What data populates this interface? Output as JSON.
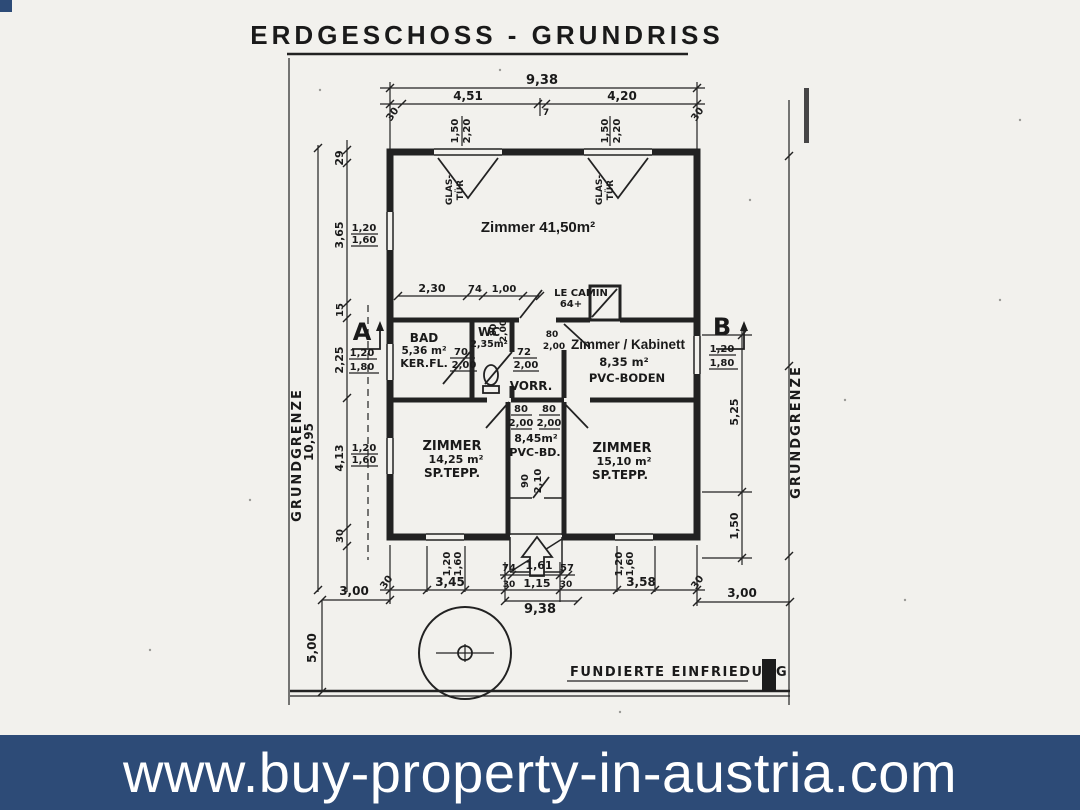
{
  "banner": {
    "text": "www.buy-property-in-austria.com",
    "bg": "#2d4b77",
    "fg": "#ffffff"
  },
  "title": "ERDGESCHOSS - GRUNDRISS",
  "markers": {
    "a": "A",
    "b": "B"
  },
  "site": {
    "boundary_left": "GRUNDGRENZE",
    "boundary_right": "GRUNDGRENZE",
    "fence": "FUNDIERTE EINFRIEDUNG",
    "dim_left_3": "3,00",
    "dim_right_3": "3,00",
    "dim_left_5": "5,00"
  },
  "rooms": {
    "main": "Zimmer 41,50m²",
    "glass_left_1": "GLAS-",
    "glass_left_2": "TÜR",
    "glass_right_1": "GLAS-",
    "glass_right_2": "TÜR",
    "bad_name": "BAD",
    "bad_area": "5,36 m²",
    "bad_floor": "KER.FL.",
    "wc_name": "WC",
    "wc_area": "2,35m²",
    "vorr_name": "VORR.",
    "vorr_area": "8,45m²",
    "vorr_floor": "PVC-BD.",
    "kamin_name": "LE CAMIN",
    "kamin_note": "64+",
    "kab_name": "Zimmer / Kabinett",
    "kab_area": "8,35 m²",
    "kab_floor": "PVC-BODEN",
    "zl_name": "ZIMMER",
    "zl_area": "14,25 m²",
    "zl_floor": "SP.TEPP.",
    "zr_name": "ZIMMER",
    "zr_area": "15,10 m²",
    "zr_floor": "SP.TEPP."
  },
  "dims": {
    "top_total": "9,38",
    "top_l": "4,51",
    "top_m": "7",
    "top_r": "4,20",
    "top_off_l": "30",
    "top_off_r": "30",
    "win_t1a": "1,50",
    "win_t1b": "2,20",
    "win_t2a": "1,50",
    "win_t2b": "2,20",
    "left_total": "10,95",
    "l1": "29",
    "l2": "3,65",
    "l3": "15",
    "l4": "2,25",
    "l5": "4,13",
    "l6": "30",
    "win_l1a": "1,20",
    "win_l1b": "1,60",
    "win_aa": "1,20",
    "win_ab": "1,80",
    "win_l2a": "1,20",
    "win_l2b": "1,60",
    "r1": "5,25",
    "r2": "1,50",
    "win_ba": "1,20",
    "win_bb": "1,80",
    "m1": "2,30",
    "m2": "74",
    "m3": "1,00",
    "door_bad_w": "70",
    "door_bad_h": "2,00",
    "door_wc_w": "72",
    "door_wc_h": "2,00",
    "door_kam_w": "80",
    "door_kam_h": "2,00",
    "door_kab_w": "80",
    "door_kab_h": "2,00",
    "corr_w1": "80",
    "corr_w2": "80",
    "corr_h1": "2,00",
    "corr_h2": "2,00",
    "entry_w": "90",
    "entry_h": "2,10",
    "b_off_l": "30",
    "b1": "3,45",
    "b2": "74",
    "b3": "1,61",
    "b4": "57",
    "b5": "3,58",
    "b_off_r": "30",
    "b6": "30",
    "b7": "1,15",
    "b8": "30",
    "bottom_total": "9,38",
    "win_b1a": "1,20",
    "win_b1b": "1,60",
    "win_b2a": "1,20",
    "win_b2b": "1,60"
  }
}
